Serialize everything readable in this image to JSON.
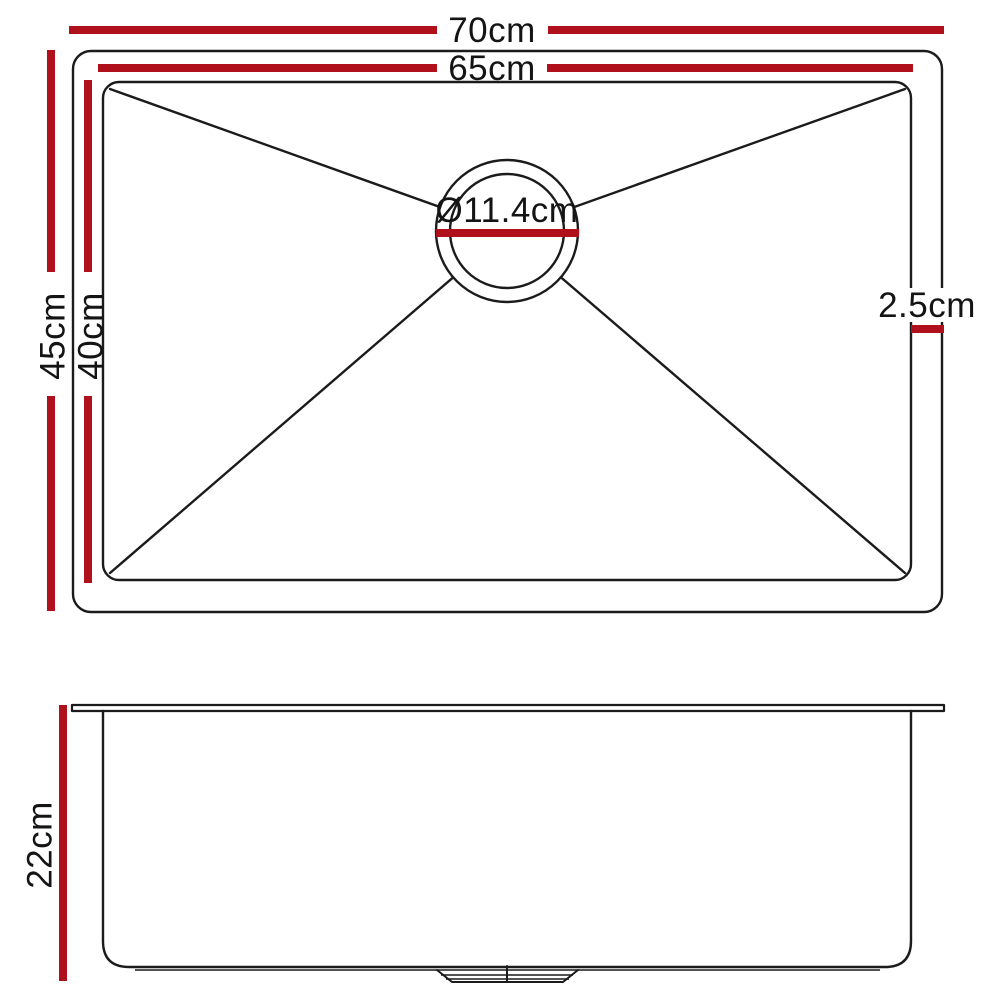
{
  "colors": {
    "dimension_red": "#AF101B",
    "outline_black": "#1B1B1B",
    "background": "#FFFFFF"
  },
  "top_view": {
    "labels": {
      "outer_width": "70cm",
      "inner_width": "65cm",
      "outer_depth": "45cm",
      "inner_depth": "40cm",
      "drain_diameter": "Ø11.4cm",
      "rim_width": "2.5cm"
    }
  },
  "side_view": {
    "labels": {
      "bowl_height": "22cm"
    }
  }
}
